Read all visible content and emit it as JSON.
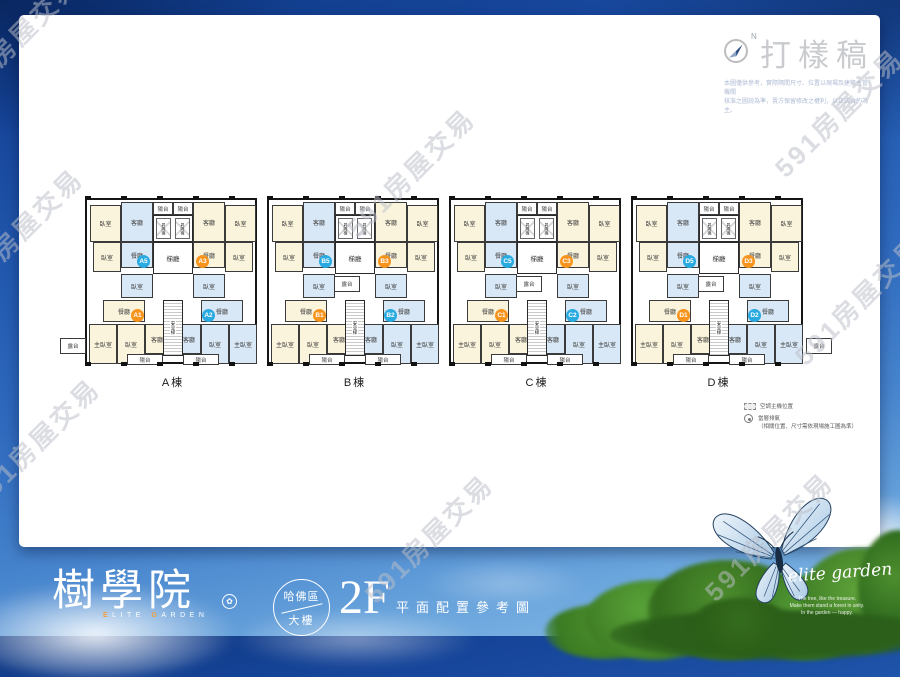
{
  "watermark": {
    "text": "591房屋交易",
    "positions": [
      [
        15,
        38
      ],
      [
        410,
        172
      ],
      [
        838,
        112
      ],
      [
        18,
        232
      ],
      [
        858,
        300
      ],
      [
        35,
        442
      ],
      [
        428,
        538
      ],
      [
        768,
        536
      ]
    ]
  },
  "proof": {
    "compass_label": "N",
    "title": "打樣稿",
    "disclaimer": [
      "本圖僅供參考，實際隔間尺寸、位置以現場及建築主管機關",
      "核准之圖說為準，賣方保留修改之權利，以正式合約為主。"
    ]
  },
  "floorplan": {
    "buildings": [
      {
        "label": "A棟",
        "units": [
          "A5",
          "A3",
          "A1",
          "A2"
        ]
      },
      {
        "label": "B棟",
        "units": [
          "B5",
          "B3",
          "B1",
          "B2"
        ]
      },
      {
        "label": "C棟",
        "units": [
          "C5",
          "C3",
          "C1",
          "C2"
        ]
      },
      {
        "label": "D棟",
        "units": [
          "D5",
          "D3",
          "D1",
          "D2"
        ]
      }
    ],
    "unit_colors": [
      "#29aae1",
      "#f7941e",
      "#f7941e",
      "#29aae1"
    ],
    "badge_positions": [
      [
        50,
        55
      ],
      [
        109,
        55
      ],
      [
        44,
        109
      ],
      [
        115,
        109
      ]
    ],
    "room_template": [
      {
        "label": "臥室",
        "x": 3,
        "y": 5,
        "w": 31,
        "h": 37,
        "fill": "cream"
      },
      {
        "label": "客廳",
        "x": 34,
        "y": 2,
        "w": 32,
        "h": 40,
        "fill": "blue"
      },
      {
        "label": "餐廳",
        "x": 34,
        "y": 42,
        "w": 32,
        "h": 26,
        "fill": "blue"
      },
      {
        "label": "臥室",
        "x": 6,
        "y": 42,
        "w": 28,
        "h": 30,
        "fill": "cream"
      },
      {
        "label": "陽台",
        "x": 66,
        "y": 2,
        "w": 20,
        "h": 13,
        "fill": "white"
      },
      {
        "label": "陽台",
        "x": 86,
        "y": 2,
        "w": 20,
        "h": 13,
        "fill": "white"
      },
      {
        "label": "客廳",
        "x": 106,
        "y": 2,
        "w": 32,
        "h": 40,
        "fill": "cream"
      },
      {
        "label": "臥室",
        "x": 138,
        "y": 5,
        "w": 31,
        "h": 37,
        "fill": "cream"
      },
      {
        "label": "餐廳",
        "x": 106,
        "y": 42,
        "w": 32,
        "h": 26,
        "fill": "cream"
      },
      {
        "label": "臥室",
        "x": 138,
        "y": 42,
        "w": 28,
        "h": 30,
        "fill": "cream"
      },
      {
        "label": "臥室",
        "x": 34,
        "y": 74,
        "w": 32,
        "h": 24,
        "fill": "blue"
      },
      {
        "label": "臥室",
        "x": 106,
        "y": 74,
        "w": 32,
        "h": 24,
        "fill": "blue"
      },
      {
        "label": "餐廳",
        "x": 16,
        "y": 100,
        "w": 42,
        "h": 22,
        "fill": "cream"
      },
      {
        "label": "餐廳",
        "x": 114,
        "y": 100,
        "w": 42,
        "h": 22,
        "fill": "blue"
      },
      {
        "label": "主臥室",
        "x": 2,
        "y": 124,
        "w": 28,
        "h": 40,
        "fill": "cream"
      },
      {
        "label": "臥室",
        "x": 30,
        "y": 124,
        "w": 28,
        "h": 40,
        "fill": "cream"
      },
      {
        "label": "客廳",
        "x": 58,
        "y": 124,
        "w": 24,
        "h": 30,
        "fill": "cream"
      },
      {
        "label": "客廳",
        "x": 90,
        "y": 124,
        "w": 24,
        "h": 30,
        "fill": "blue"
      },
      {
        "label": "臥室",
        "x": 114,
        "y": 124,
        "w": 28,
        "h": 40,
        "fill": "blue"
      },
      {
        "label": "主臥室",
        "x": 142,
        "y": 124,
        "w": 28,
        "h": 40,
        "fill": "blue"
      },
      {
        "label": "陽台",
        "x": 40,
        "y": 154,
        "w": 36,
        "h": 11,
        "fill": "white"
      },
      {
        "label": "陽台",
        "x": 96,
        "y": 154,
        "w": 36,
        "h": 11,
        "fill": "white"
      }
    ],
    "core": {
      "elevator": "昇降機",
      "hall": "梯廳",
      "stair": "安全梯",
      "terrace": "露台"
    },
    "terrace_positions": [
      [
        249,
        78
      ],
      [
        431,
        78
      ],
      [
        613,
        78
      ],
      [
        -25,
        140
      ],
      [
        721,
        140
      ]
    ],
    "legend": [
      {
        "icon": "dashed-rect",
        "text": "空調主機位置",
        "note": ""
      },
      {
        "icon": "circle",
        "text": "當層排氣",
        "note": "（相關位置、尺寸需依現場施工圖為準）"
      }
    ]
  },
  "footer": {
    "logo_cn": "樹學院",
    "logo_en": "ELITE GARDEN",
    "seal_glyph": "✿",
    "badge_top": "哈佛區",
    "badge_bottom": "大樓",
    "floor": "2F",
    "caption": "平面配置參考圖",
    "script": "elite garden",
    "script_lines": [
      "The tree, like the treasure.",
      "Make them stand a forest in unity.",
      "In the garden — happy."
    ]
  }
}
